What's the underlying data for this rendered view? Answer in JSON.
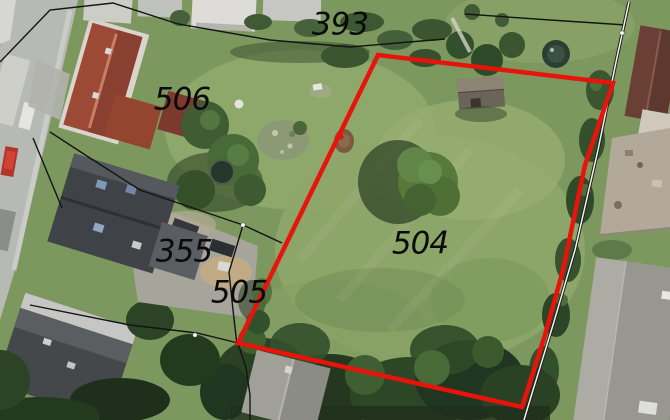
{
  "map": {
    "description": "Aerial cadastral photo with parcel boundaries and highlighted plot",
    "colors": {
      "highlight": "#e8130b",
      "boundary": "#141414",
      "road_edge_outer": "#1c1c1c",
      "road_edge_core": "#f4f2ea",
      "label_text": "#0b0b0b",
      "marker": "#ffffff"
    },
    "parcels": [
      {
        "id": "393"
      },
      {
        "id": "506"
      },
      {
        "id": "355"
      },
      {
        "id": "505"
      },
      {
        "id": "504"
      }
    ],
    "highlight_parcel": {
      "parcel_id": "504",
      "points": "378,55 613,83 585,165 563,270 545,335 522,407 238,343",
      "stroke_width": 4.5
    },
    "boundary_lines": [
      "0,62 50,10 113,3 178,24 270,40 350,47 445,39",
      "465,14 550,20 626,25",
      "33,138 62,208",
      "50,132 90,158 140,190 190,207 243,225",
      "243,225 282,243",
      "243,225 229,272 233,310 237,345",
      "30,305 130,325 197,333 238,343",
      "238,343 246,368 250,395 250,420"
    ],
    "double_boundary_line": "629,2 616,62 598,150 575,250 553,325 530,400 524,420",
    "survey_markers": [
      [
        243,
        225
      ],
      [
        195,
        335
      ],
      [
        622,
        33
      ]
    ]
  }
}
